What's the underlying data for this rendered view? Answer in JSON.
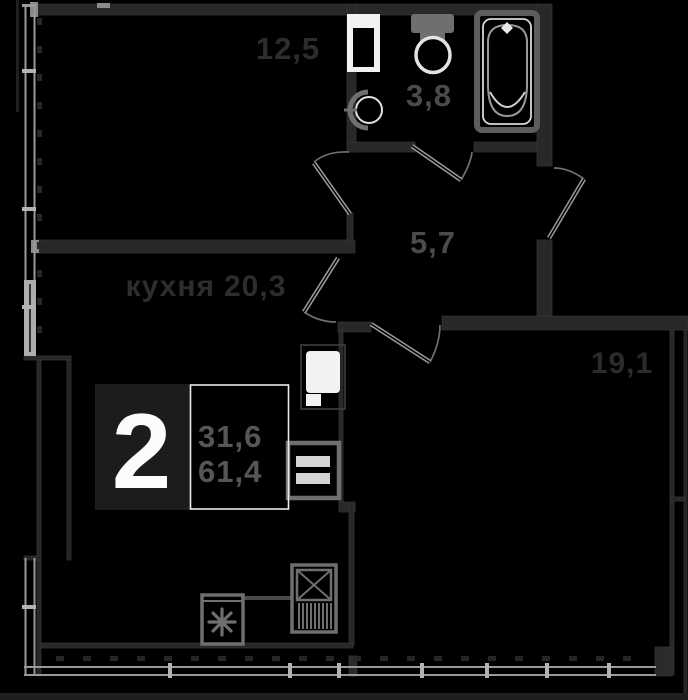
{
  "plan": {
    "title": "apartment-floor-plan",
    "badge": {
      "rooms_count": "2",
      "living_area": "31,6",
      "total_area": "61,4"
    },
    "rooms": [
      {
        "key": "room-12-5",
        "name": "",
        "area": "12,5"
      },
      {
        "key": "bathroom",
        "name": "",
        "area": "3,8"
      },
      {
        "key": "hallway",
        "name": "",
        "area": "5,7"
      },
      {
        "key": "kitchen",
        "name": "кухня",
        "area": "20,3"
      },
      {
        "key": "room-19-1",
        "name": "",
        "area": "19,1"
      }
    ],
    "icons": [
      "washing-machine-icon",
      "toilet-icon",
      "sink-icon",
      "bathtub-icon",
      "kitchen-sink-icon",
      "kitchen-cabinet-icon",
      "stove-icon",
      "fridge-icon",
      "door-swing-icon",
      "snowflake-icon"
    ],
    "colors": {
      "background": "#000000",
      "walls": "#282828",
      "window_glazing": "#9a9a9a",
      "fixtures": "#6f6f6f",
      "fixture_light": "#e3e3e3",
      "label_dark": "#2d2d2d",
      "label_light": "#4b4b4b",
      "badge_box": "#1c1c1a",
      "badge_number": "#fcfcfc",
      "badge_values": "#565656"
    }
  }
}
